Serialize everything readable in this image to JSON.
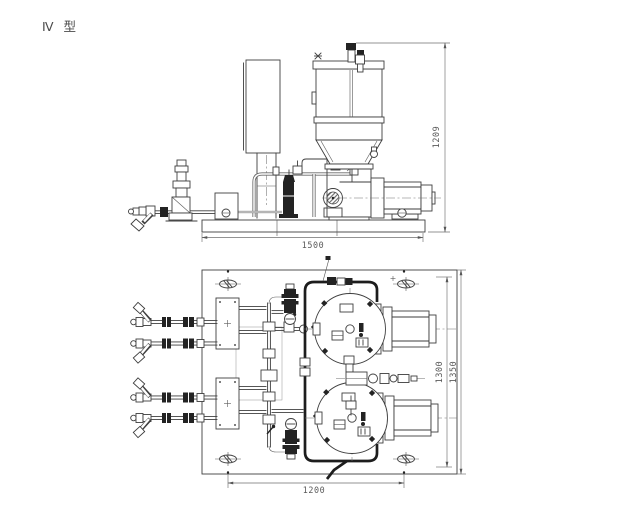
{
  "drawing": {
    "title": "Ⅳ 型",
    "views": {
      "elevation": {
        "dim_length": "1500",
        "dim_height": "1209"
      },
      "plan": {
        "dim_length": "1200",
        "dim_width_inner": "1300",
        "dim_width_outer": "1350"
      }
    },
    "colors": {
      "paper": "#ffffff",
      "line": "#3e3e3e",
      "dim_text": "#5a5a5a",
      "dark_fill": "#232323"
    }
  }
}
